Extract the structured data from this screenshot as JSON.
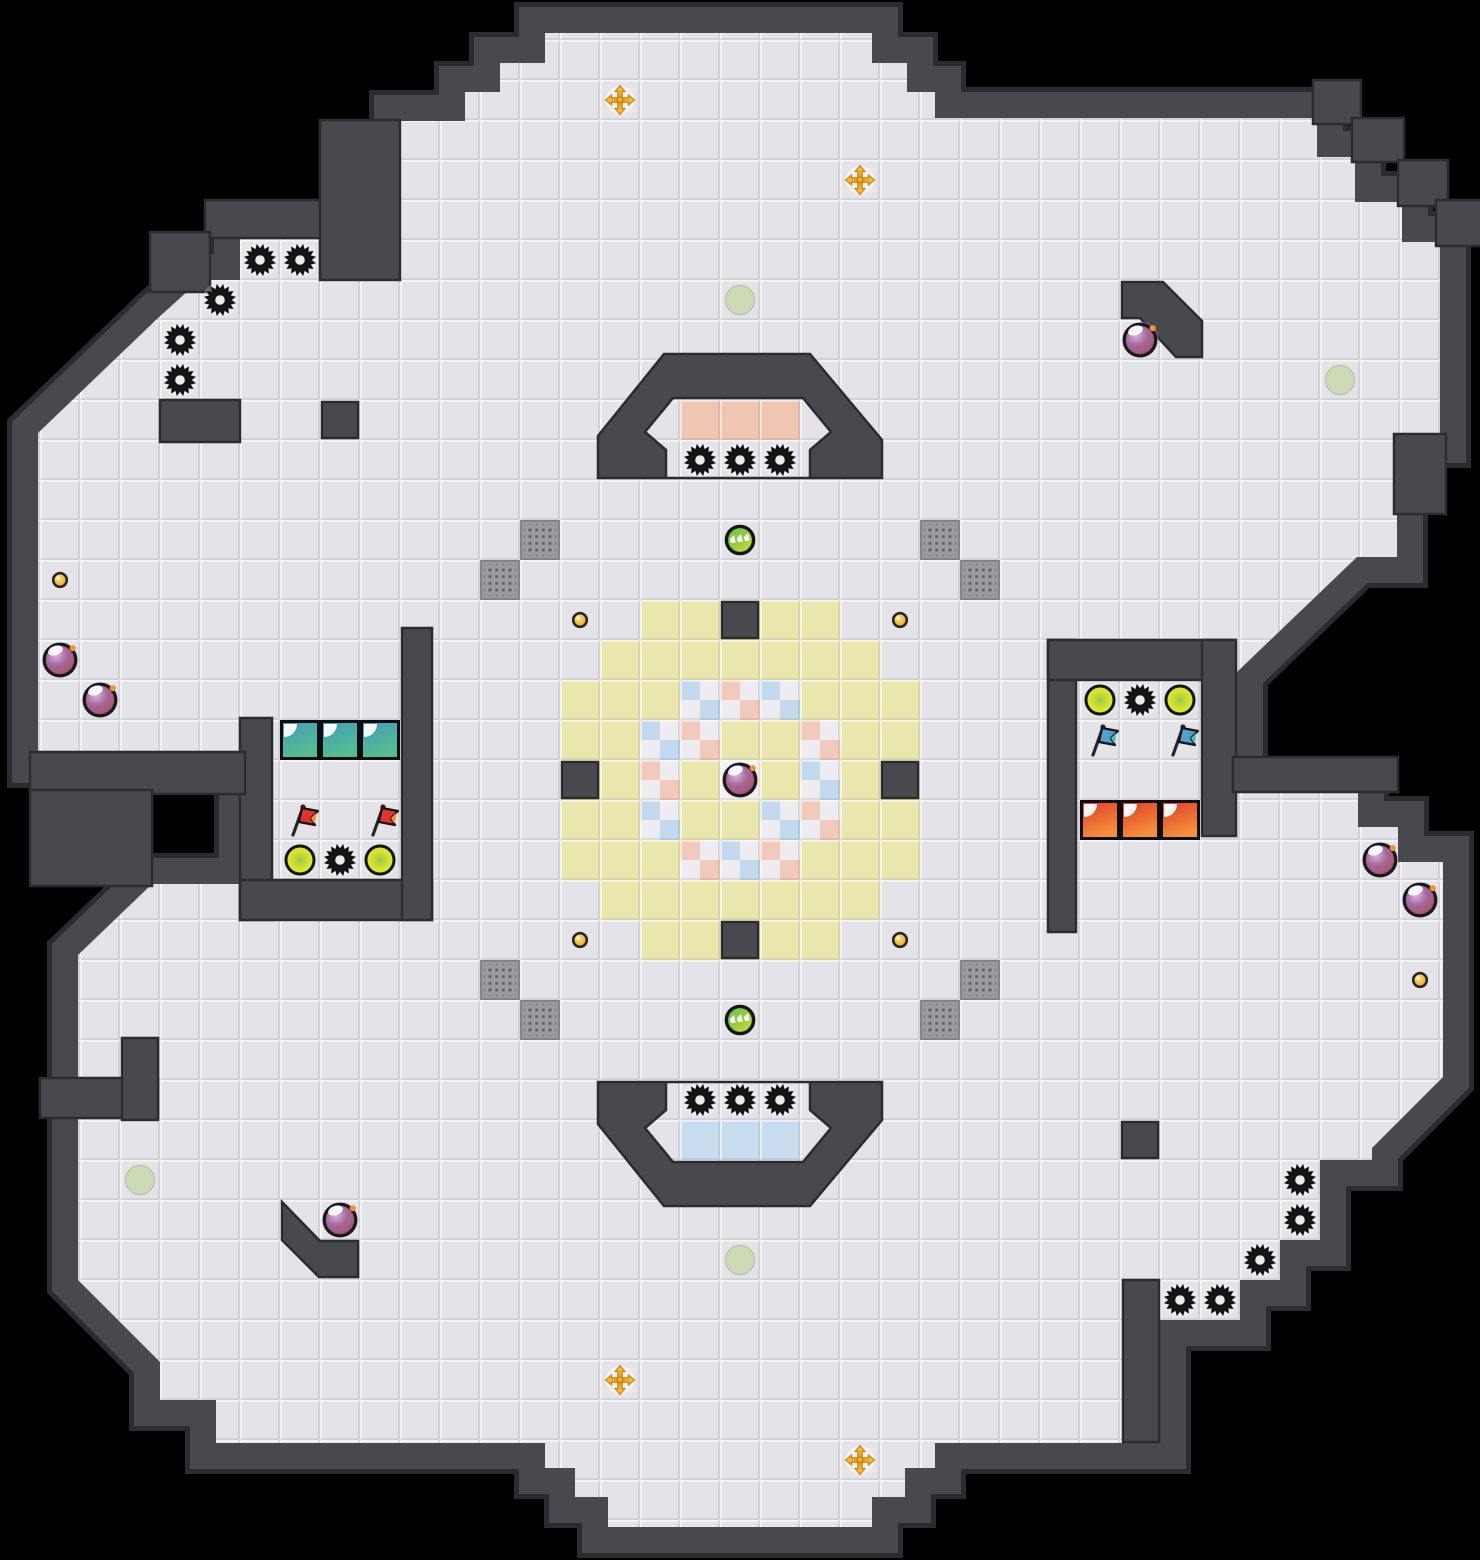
{
  "meta": {
    "view": "tile-map",
    "canvas_width": 1480,
    "canvas_height": 1560,
    "tile_size": 40
  },
  "palette": {
    "void": "#000000",
    "wall": "#48484e",
    "wall_edge": "#2c2c30",
    "floor": "#e4e3e8",
    "yellow_zone": "#eae7ae",
    "pink_tile": "#f0c5b2",
    "blue_tile": "#c9ddf0",
    "checker_white": "#edecf1",
    "checker_pink": "#f2c9bb",
    "checker_blue": "#c3d9ed",
    "center_tile": "#f2f1f5",
    "gate_base": "#9b9aa1",
    "gate_dot": "#63626a",
    "spike": "#151515",
    "bomb_outline": "#1c1c1f",
    "fuse_orange": "#f2932d",
    "button_gold": "#f5a413",
    "portal_orange": "#ef9214",
    "spawn_green": "#ccdcb6",
    "flag_red": "#e63327",
    "flag_red_tip": "#f59122",
    "flag_blue": "#4f9fd0",
    "flag_blue_tip": "#3fc9a0",
    "team_teal_top": "#3f9dc0",
    "team_teal_bottom": "#55be8b",
    "team_red_top": "#e03a26",
    "team_red_bottom": "#f4913a"
  },
  "map": {
    "floor_outline": [
      [
        545,
        33
      ],
      [
        872,
        33
      ],
      [
        872,
        63
      ],
      [
        907,
        63
      ],
      [
        907,
        92
      ],
      [
        935,
        92
      ],
      [
        935,
        118
      ],
      [
        1317,
        118
      ],
      [
        1317,
        157
      ],
      [
        1355,
        157
      ],
      [
        1355,
        202
      ],
      [
        1402,
        202
      ],
      [
        1402,
        242
      ],
      [
        1440,
        242
      ],
      [
        1440,
        437
      ],
      [
        1397,
        437
      ],
      [
        1397,
        557
      ],
      [
        1357,
        557
      ],
      [
        1237,
        672
      ],
      [
        1237,
        790
      ],
      [
        1358,
        790
      ],
      [
        1358,
        827
      ],
      [
        1398,
        827
      ],
      [
        1398,
        862
      ],
      [
        1443,
        862
      ],
      [
        1443,
        1077
      ],
      [
        1372,
        1148
      ],
      [
        1372,
        1160
      ],
      [
        1320,
        1160
      ],
      [
        1320,
        1240
      ],
      [
        1280,
        1240
      ],
      [
        1280,
        1280
      ],
      [
        1240,
        1280
      ],
      [
        1240,
        1320
      ],
      [
        1160,
        1320
      ],
      [
        1160,
        1443
      ],
      [
        935,
        1443
      ],
      [
        935,
        1468
      ],
      [
        905,
        1468
      ],
      [
        905,
        1497
      ],
      [
        872,
        1497
      ],
      [
        872,
        1527
      ],
      [
        608,
        1527
      ],
      [
        608,
        1497
      ],
      [
        575,
        1497
      ],
      [
        575,
        1468
      ],
      [
        545,
        1468
      ],
      [
        545,
        1443
      ],
      [
        216,
        1443
      ],
      [
        216,
        1400
      ],
      [
        160,
        1400
      ],
      [
        160,
        1362
      ],
      [
        78,
        1280
      ],
      [
        78,
        955
      ],
      [
        152,
        884
      ],
      [
        245,
        884
      ],
      [
        245,
        757
      ],
      [
        38,
        757
      ],
      [
        38,
        433
      ],
      [
        158,
        318
      ],
      [
        200,
        280
      ],
      [
        240,
        280
      ],
      [
        240,
        235
      ],
      [
        320,
        235
      ],
      [
        320,
        280
      ],
      [
        400,
        280
      ],
      [
        400,
        121
      ],
      [
        465,
        121
      ],
      [
        465,
        92
      ],
      [
        500,
        92
      ],
      [
        500,
        63
      ],
      [
        545,
        63
      ]
    ],
    "yellow_zone": [
      [
        640,
        600
      ],
      [
        840,
        600
      ],
      [
        840,
        640
      ],
      [
        880,
        640
      ],
      [
        880,
        680
      ],
      [
        920,
        680
      ],
      [
        920,
        880
      ],
      [
        880,
        880
      ],
      [
        880,
        920
      ],
      [
        840,
        920
      ],
      [
        840,
        960
      ],
      [
        640,
        960
      ],
      [
        640,
        920
      ],
      [
        600,
        920
      ],
      [
        600,
        880
      ],
      [
        560,
        880
      ],
      [
        560,
        680
      ],
      [
        600,
        680
      ],
      [
        600,
        640
      ],
      [
        640,
        640
      ]
    ],
    "wall_rects": [
      [
        240,
        718,
        32,
        202
      ],
      [
        240,
        880,
        192,
        40
      ],
      [
        402,
        628,
        30,
        292
      ],
      [
        1048,
        640,
        28,
        292
      ],
      [
        1048,
        640,
        184,
        40
      ],
      [
        1202,
        640,
        34,
        196
      ],
      [
        1233,
        757,
        165,
        35
      ],
      [
        722,
        602,
        36,
        36
      ],
      [
        562,
        762,
        36,
        36
      ],
      [
        882,
        762,
        36,
        36
      ],
      [
        722,
        922,
        36,
        36
      ],
      [
        322,
        402,
        36,
        36
      ],
      [
        1122,
        1122,
        36,
        36
      ],
      [
        30,
        752,
        215,
        42
      ],
      [
        30,
        790,
        122,
        96
      ],
      [
        160,
        400,
        80,
        42
      ],
      [
        1123,
        1280,
        36,
        162
      ],
      [
        40,
        1078,
        118,
        40
      ],
      [
        122,
        1038,
        36,
        82
      ],
      [
        1313,
        80,
        48,
        44
      ],
      [
        1352,
        118,
        52,
        44
      ],
      [
        1398,
        160,
        50,
        46
      ],
      [
        1436,
        200,
        46,
        46
      ],
      [
        1394,
        434,
        52,
        80
      ],
      [
        205,
        200,
        120,
        38
      ],
      [
        320,
        120,
        80,
        160
      ],
      [
        150,
        232,
        60,
        60
      ]
    ],
    "wall_polys": [
      [
        [
          1122,
          282
        ],
        [
          1163,
          282
        ],
        [
          1202,
          321
        ],
        [
          1202,
          357
        ],
        [
          1176,
          357
        ],
        [
          1140,
          318
        ],
        [
          1122,
          318
        ]
      ],
      [
        [
          282,
          1202
        ],
        [
          282,
          1240
        ],
        [
          319,
          1277
        ],
        [
          358,
          1277
        ],
        [
          358,
          1241
        ],
        [
          320,
          1241
        ]
      ]
    ],
    "arch_top": {
      "outer": [
        [
          598,
          478
        ],
        [
          598,
          436
        ],
        [
          664,
          354
        ],
        [
          810,
          354
        ],
        [
          882,
          440
        ],
        [
          882,
          478
        ]
      ],
      "hole": [
        [
          666,
          478
        ],
        [
          666,
          450
        ],
        [
          645,
          432
        ],
        [
          673,
          398
        ],
        [
          803,
          398
        ],
        [
          831,
          432
        ],
        [
          810,
          450
        ],
        [
          810,
          478
        ]
      ]
    },
    "arch_bottom": {
      "outer": [
        [
          598,
          1082
        ],
        [
          882,
          1082
        ],
        [
          882,
          1120
        ],
        [
          810,
          1206
        ],
        [
          664,
          1206
        ],
        [
          598,
          1124
        ]
      ],
      "hole": [
        [
          666,
          1082
        ],
        [
          810,
          1082
        ],
        [
          810,
          1110
        ],
        [
          831,
          1128
        ],
        [
          803,
          1162
        ],
        [
          673,
          1162
        ],
        [
          645,
          1128
        ],
        [
          666,
          1110
        ]
      ]
    }
  },
  "tiles": {
    "pink": [
      [
        17,
        10
      ],
      [
        18,
        10
      ],
      [
        19,
        10
      ]
    ],
    "blue": [
      [
        17,
        28
      ],
      [
        18,
        28
      ],
      [
        19,
        28
      ]
    ],
    "center_white": [
      [
        18,
        19
      ]
    ],
    "checker": [
      [
        17,
        17,
        "b"
      ],
      [
        18,
        17,
        "p"
      ],
      [
        19,
        17,
        "b"
      ],
      [
        16,
        18,
        "b"
      ],
      [
        17,
        18,
        "p"
      ],
      [
        20,
        18,
        "p"
      ],
      [
        16,
        19,
        "p"
      ],
      [
        20,
        19,
        "b"
      ],
      [
        16,
        20,
        "b"
      ],
      [
        19,
        20,
        "b"
      ],
      [
        20,
        20,
        "p"
      ],
      [
        17,
        21,
        "p"
      ],
      [
        18,
        21,
        "b"
      ],
      [
        19,
        21,
        "p"
      ]
    ],
    "team_teal": [
      [
        7,
        18
      ],
      [
        8,
        18
      ],
      [
        9,
        18
      ]
    ],
    "team_red": [
      [
        27,
        20
      ],
      [
        28,
        20
      ],
      [
        29,
        20
      ]
    ],
    "gates": [
      [
        13,
        13
      ],
      [
        12,
        14
      ],
      [
        23,
        13
      ],
      [
        24,
        14
      ],
      [
        12,
        24
      ],
      [
        13,
        25
      ],
      [
        24,
        24
      ],
      [
        23,
        25
      ]
    ]
  },
  "objects": {
    "spikes": [
      [
        6,
        6
      ],
      [
        7,
        6
      ],
      [
        5,
        7
      ],
      [
        4,
        8
      ],
      [
        4,
        9
      ],
      [
        17,
        11
      ],
      [
        18,
        11
      ],
      [
        19,
        11
      ],
      [
        8,
        21
      ],
      [
        28,
        17
      ],
      [
        17,
        27
      ],
      [
        18,
        27
      ],
      [
        19,
        27
      ],
      [
        32,
        29
      ],
      [
        32,
        30
      ],
      [
        31,
        31
      ],
      [
        29,
        32
      ],
      [
        30,
        32
      ]
    ],
    "bombs": [
      [
        28,
        8
      ],
      [
        1,
        16
      ],
      [
        2,
        17
      ],
      [
        18,
        19
      ],
      [
        34,
        21
      ],
      [
        35,
        22
      ],
      [
        8,
        30
      ]
    ],
    "jukes": [
      [
        18,
        13
      ],
      [
        18,
        25
      ]
    ],
    "boosts": [
      [
        7,
        21
      ],
      [
        9,
        21
      ],
      [
        27,
        17
      ],
      [
        29,
        17
      ]
    ],
    "flags_red": [
      [
        7,
        20
      ],
      [
        9,
        20
      ]
    ],
    "flags_blue": [
      [
        27,
        18
      ],
      [
        29,
        18
      ]
    ],
    "buttons": [
      [
        14,
        15
      ],
      [
        22,
        15
      ],
      [
        14,
        23
      ],
      [
        22,
        23
      ],
      [
        1,
        14
      ],
      [
        35,
        24
      ]
    ],
    "portals": [
      [
        15,
        2
      ],
      [
        21,
        4
      ],
      [
        15,
        34
      ],
      [
        21,
        36
      ]
    ],
    "spawns": [
      [
        18,
        7
      ],
      [
        33,
        9
      ],
      [
        3,
        29
      ],
      [
        18,
        31
      ]
    ]
  }
}
